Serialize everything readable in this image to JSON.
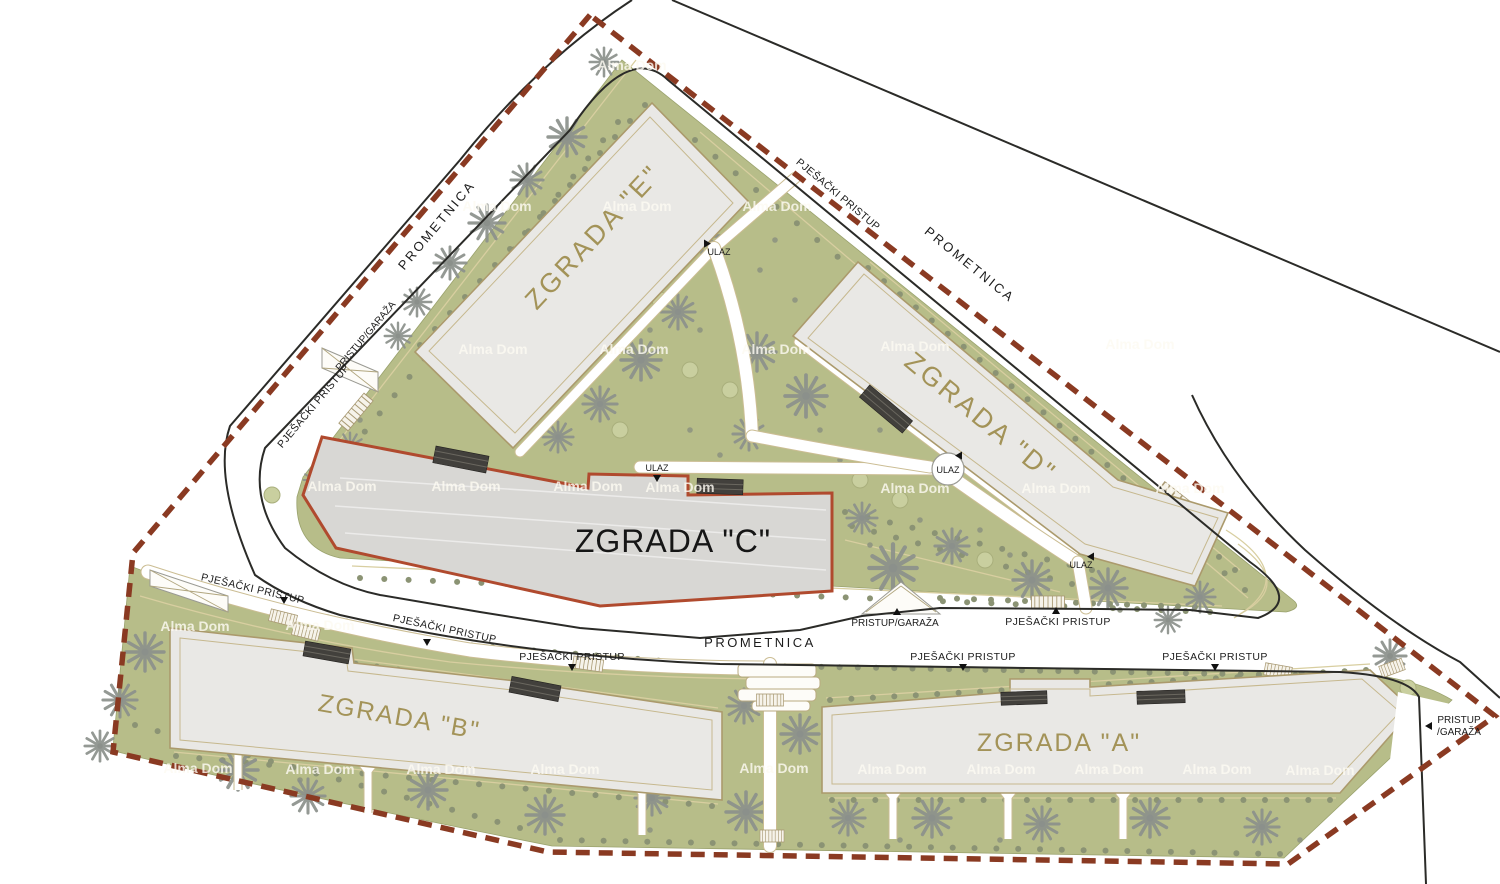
{
  "title": "Residential complex site plan",
  "labels": {
    "road": "PROMETNICA",
    "pedestrian_access": "PJEŠAČKI PRISTUP",
    "garage_access": "PRISTUP/GARAŽA",
    "garage_access_l1": "PRISTUP",
    "garage_access_l2": "/GARAŽA",
    "entrance": "ULAZ",
    "watermark": "Alma Dom"
  },
  "buildings": {
    "a": {
      "label": "ZGRADA \"A\""
    },
    "b": {
      "label": "ZGRADA \"B\""
    },
    "c": {
      "label": "ZGRADA \"C\"",
      "highlighted": true
    },
    "d": {
      "label": "ZGRADA \"D\""
    },
    "e": {
      "label": "ZGRADA \"E\""
    }
  },
  "colors": {
    "site_green": "#b7bd89",
    "tree_gray": "#8b908b",
    "building_fill": "#e9e8e5",
    "building_c_fill": "#d8d7d4",
    "building_outline": "#ab9a6c",
    "highlight_red": "#b04a2e",
    "boundary_dash": "#8a3a22",
    "road_line": "#2b2b28",
    "building_label_tan": "#a39358"
  },
  "decor": {
    "palms": [
      [
        567,
        137,
        1
      ],
      [
        527,
        180,
        0.85
      ],
      [
        487,
        223,
        0.95
      ],
      [
        450,
        263,
        0.85
      ],
      [
        417,
        302,
        0.75
      ],
      [
        398,
        336,
        0.7
      ],
      [
        604,
        62,
        0.75
      ],
      [
        702,
        236,
        1
      ],
      [
        678,
        312,
        0.9
      ],
      [
        641,
        360,
        1.05
      ],
      [
        600,
        404,
        0.9
      ],
      [
        558,
        437,
        0.8
      ],
      [
        757,
        352,
        1
      ],
      [
        806,
        396,
        1.1
      ],
      [
        749,
        434,
        0.85
      ],
      [
        893,
        568,
        1.25
      ],
      [
        952,
        546,
        0.9
      ],
      [
        1032,
        580,
        1
      ],
      [
        1108,
        588,
        1
      ],
      [
        1200,
        597,
        0.8
      ],
      [
        862,
        518,
        0.8
      ],
      [
        350,
        446,
        0.7
      ],
      [
        315,
        480,
        0.6
      ],
      [
        1168,
        620,
        0.7
      ],
      [
        145,
        652,
        1
      ],
      [
        120,
        700,
        0.9
      ],
      [
        100,
        746,
        0.8
      ],
      [
        238,
        770,
        1.05
      ],
      [
        308,
        796,
        0.9
      ],
      [
        428,
        790,
        1
      ],
      [
        545,
        815,
        1
      ],
      [
        652,
        798,
        0.9
      ],
      [
        744,
        706,
        0.9
      ],
      [
        800,
        734,
        1
      ],
      [
        746,
        812,
        1.05
      ],
      [
        848,
        818,
        0.9
      ],
      [
        932,
        818,
        1
      ],
      [
        1042,
        824,
        0.9
      ],
      [
        1150,
        818,
        1
      ],
      [
        1262,
        827,
        0.9
      ],
      [
        1390,
        656,
        0.85
      ],
      [
        1338,
        700,
        0.7
      ]
    ],
    "bushes": [
      [
        272,
        495
      ],
      [
        660,
        300
      ],
      [
        690,
        370
      ],
      [
        730,
        390
      ],
      [
        620,
        430
      ],
      [
        860,
        480
      ],
      [
        900,
        500
      ],
      [
        1060,
        545
      ],
      [
        985,
        560
      ],
      [
        540,
        500
      ],
      [
        480,
        530
      ],
      [
        250,
        700
      ],
      [
        360,
        740
      ],
      [
        580,
        760
      ],
      [
        900,
        770
      ],
      [
        1100,
        780
      ],
      [
        1330,
        760
      ],
      [
        1408,
        688
      ]
    ],
    "dot_rows": [
      [
        335,
        468,
        618,
        122,
        20
      ],
      [
        420,
        345,
        645,
        105,
        16
      ],
      [
        695,
        140,
        1245,
        590,
        28
      ],
      [
        360,
        578,
        1210,
        612,
        36
      ],
      [
        350,
        462,
        575,
        498,
        12
      ],
      [
        845,
        512,
        1092,
        570,
        12
      ],
      [
        852,
        526,
        1072,
        584,
        11
      ],
      [
        868,
        268,
        1235,
        570,
        24
      ],
      [
        940,
        598,
        1195,
        607,
        16
      ],
      [
        162,
        580,
        420,
        638,
        15
      ],
      [
        430,
        642,
        700,
        664,
        14
      ],
      [
        712,
        665,
        1350,
        676,
        36
      ],
      [
        186,
        640,
        716,
        714,
        26
      ],
      [
        176,
        756,
        712,
        806,
        24
      ],
      [
        830,
        700,
        1366,
        670,
        26
      ],
      [
        832,
        800,
        1330,
        800,
        24
      ],
      [
        560,
        840,
        1280,
        854,
        34
      ],
      [
        135,
        725,
        520,
        828,
        18
      ]
    ],
    "dots": [
      [
        640,
        200
      ],
      [
        665,
        230
      ],
      [
        610,
        300
      ],
      [
        650,
        330
      ],
      [
        700,
        330
      ],
      [
        730,
        300
      ],
      [
        760,
        270
      ],
      [
        690,
        430
      ],
      [
        720,
        455
      ],
      [
        820,
        430
      ],
      [
        840,
        460
      ],
      [
        880,
        430
      ],
      [
        920,
        520
      ],
      [
        980,
        530
      ],
      [
        1010,
        555
      ],
      [
        1120,
        610
      ],
      [
        360,
        420
      ],
      [
        330,
        500
      ],
      [
        390,
        540
      ],
      [
        460,
        550
      ],
      [
        520,
        560
      ],
      [
        830,
        545
      ],
      [
        870,
        545
      ],
      [
        180,
        680
      ],
      [
        260,
        700
      ],
      [
        340,
        720
      ],
      [
        420,
        745
      ],
      [
        500,
        760
      ],
      [
        620,
        770
      ],
      [
        700,
        780
      ],
      [
        860,
        760
      ],
      [
        950,
        790
      ],
      [
        1060,
        790
      ],
      [
        1170,
        790
      ],
      [
        1280,
        790
      ],
      [
        1350,
        700
      ],
      [
        1300,
        840
      ],
      [
        900,
        840
      ],
      [
        1000,
        840
      ],
      [
        650,
        830
      ],
      [
        300,
        780
      ],
      [
        200,
        745
      ],
      [
        795,
        300
      ],
      [
        775,
        240
      ],
      [
        700,
        200
      ]
    ],
    "ladders": [
      [
        356,
        412,
        -50,
        1.3
      ],
      [
        1185,
        505,
        38,
        2
      ],
      [
        283,
        618,
        14,
        0.9
      ],
      [
        306,
        632,
        14,
        0.9
      ],
      [
        588,
        664,
        8,
        1
      ],
      [
        770,
        700,
        0,
        0.9
      ],
      [
        772,
        836,
        0,
        0.8
      ],
      [
        1392,
        668,
        -20,
        0.8
      ],
      [
        1048,
        602,
        0,
        1.1
      ],
      [
        1278,
        671,
        10,
        0.9
      ]
    ],
    "ypaths": [
      [
        238,
        748
      ],
      [
        368,
        771
      ],
      [
        642,
        793
      ],
      [
        893,
        797
      ],
      [
        1008,
        797
      ],
      [
        1123,
        797
      ]
    ],
    "watermarks": [
      [
        632,
        70
      ],
      [
        497,
        211
      ],
      [
        637,
        211
      ],
      [
        777,
        211
      ],
      [
        493,
        354
      ],
      [
        634,
        354
      ],
      [
        776,
        354
      ],
      [
        915,
        351
      ],
      [
        1140,
        349
      ],
      [
        342,
        491
      ],
      [
        466,
        491
      ],
      [
        588,
        491
      ],
      [
        680,
        492
      ],
      [
        915,
        493
      ],
      [
        1056,
        493
      ],
      [
        1190,
        493
      ],
      [
        195,
        631
      ],
      [
        320,
        630
      ],
      [
        198,
        773
      ],
      [
        320,
        774
      ],
      [
        441,
        774
      ],
      [
        565,
        774
      ],
      [
        774,
        773
      ],
      [
        892,
        774
      ],
      [
        1001,
        774
      ],
      [
        1109,
        774
      ],
      [
        1217,
        774
      ],
      [
        1320,
        775
      ]
    ]
  }
}
